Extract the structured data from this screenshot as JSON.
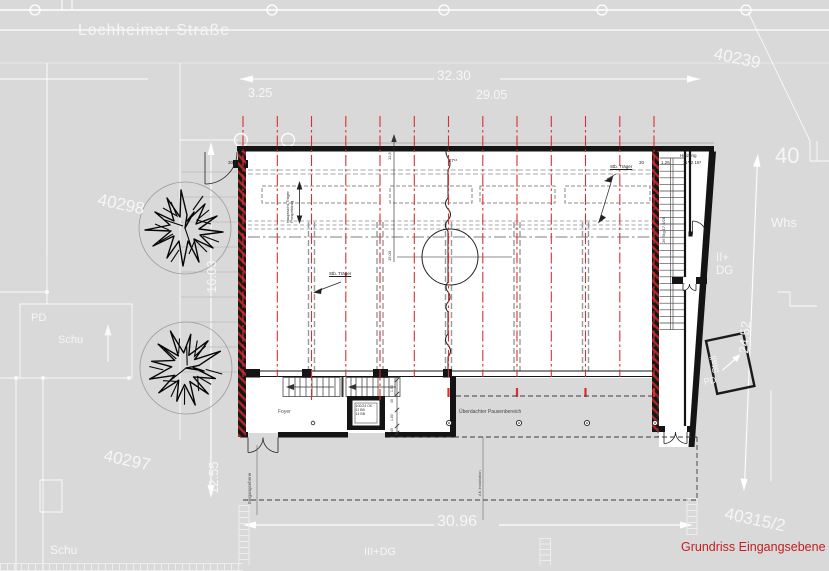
{
  "street": {
    "name": "Lochheimer Straße"
  },
  "parcels": {
    "n40239": "40239",
    "n40298": "40298",
    "n40297": "40297",
    "n40315_2": "40315/2",
    "n40": "40"
  },
  "zones": {
    "whs": "Whs",
    "ii_dg": "II+\nDG",
    "iii_dg": "III+DG",
    "pd_left": "PD",
    "schu_left": "Schu",
    "schu_bottom": "Schu",
    "stall": "Stall",
    "stall_pd": "PD"
  },
  "dims": {
    "d3_25": "3.25",
    "d32_30": "32.30",
    "d29_05": "29.05",
    "d30_96": "30.96",
    "d24_52": "24.52",
    "d12_55": "12.55",
    "d16_03": "16.03",
    "d30_a": "30",
    "d30_b": "30",
    "d1_25": "1.25",
    "heizung_size": "11⁵  2.16⁵",
    "d27": "27¹⁶",
    "d15_00": "15.00",
    "d12_5": "12,5",
    "chain": [
      "1.50",
      "45",
      "1.80",
      "45"
    ]
  },
  "rooms": {
    "heizung": "Heizung",
    "foyer": "Foyer",
    "pausenbereich": "Überdachter Pausenbereich"
  },
  "notes": {
    "stb_traeger_1": "Stb. Träger",
    "stb_traeger_2": "Stb. Träger",
    "haupt": "Hauptsicht-Träger\nProspektzug",
    "stair_spec": "26 Stg 17,9/28",
    "eingang": "Eingangsebene",
    "ak_install": "AK Installation",
    "lift": "100/24 OK\n11 BB\n14 BB"
  },
  "title": {
    "text": "Grundriss Eingangsebene"
  },
  "colors": {
    "background": "#d9d9d9",
    "axis_red": "#d83030",
    "title_red": "#c22020",
    "line_white": "#ffffff",
    "ink": "#141414"
  }
}
